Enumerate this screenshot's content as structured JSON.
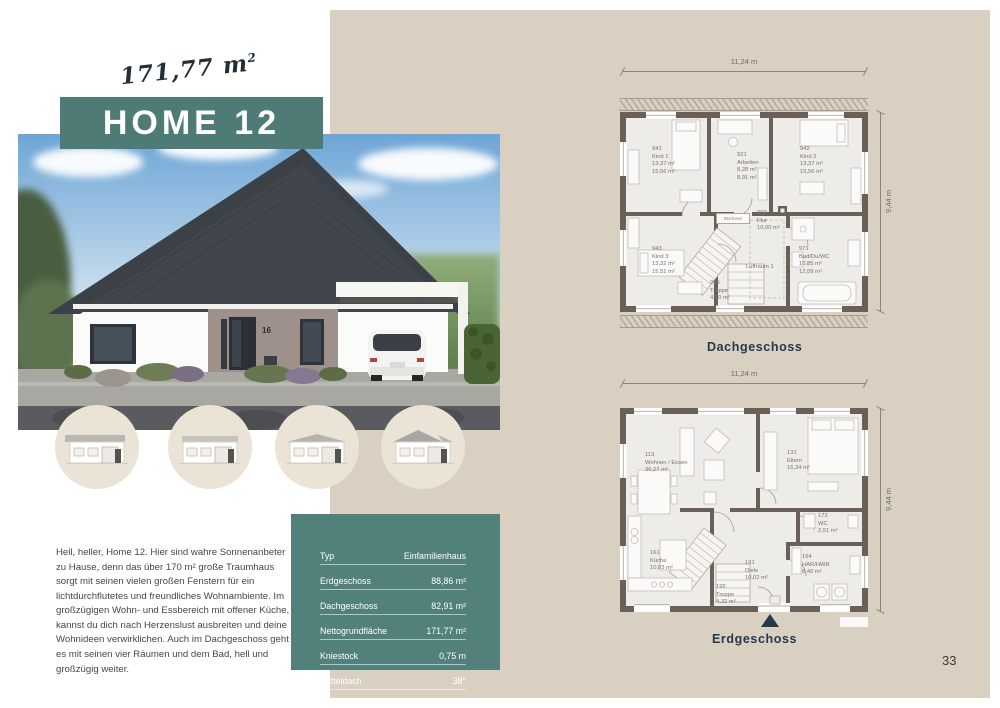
{
  "colors": {
    "accent_teal": "#4e7b76",
    "navy": "#25394c",
    "beige": "#d9d0c2"
  },
  "header": {
    "area_value": "171,77 m",
    "area_sup": "2",
    "title": "HOME 12"
  },
  "photo": {
    "house_number": "16"
  },
  "intro": "Hell, heller, Home 12. Hier sind wahre Sonnenanbeter zu Hause, denn das über 170 m² große Traumhaus sorgt mit seinen vielen großen Fenstern für ein lichtdurchflutetes und freundliches Wohnambiente. Im großzügigen Wohn- und Essbereich mit offener Küche, kannst du dich nach Herzenslust ausbreiten und deine Wohnideen verwirklichen. Auch im Dachgeschoss geht es mit seinen vier Räumen und dem Bad, hell und großzügig weiter.",
  "specs": {
    "rows": [
      {
        "label": "Typ",
        "value": "Einfamilienhaus"
      },
      {
        "label": "Erdgeschoss",
        "value": "88,86 m²"
      },
      {
        "label": "Dachgeschoss",
        "value": "82,91 m²"
      },
      {
        "label": "Nettogrundfläche",
        "value": "171,77 m²"
      },
      {
        "label": "Kniestock",
        "value": "0,75 m"
      },
      {
        "label": "Satteldach",
        "value": "38°"
      }
    ]
  },
  "plans": {
    "dg": {
      "caption": "Dachgeschoss",
      "width_dim": "11,24 m",
      "depth_dim": "9,44 m",
      "luftraum": "Luftraum 1",
      "shelf_label": "Bücherei",
      "rooms": [
        {
          "code": "941",
          "name": "Kind 1",
          "a1": "13,37 m²",
          "a2": "15,56 m²"
        },
        {
          "code": "921",
          "name": "Arbeiten",
          "a1": "8,28 m²",
          "a2": "8,91 m²"
        },
        {
          "code": "942",
          "name": "Kind 2",
          "a1": "13,37 m²",
          "a2": "15,56 m²"
        },
        {
          "code": "943",
          "name": "Kind 3",
          "a1": "13,32 m²",
          "a2": "15,51 m²"
        },
        {
          "code": "992",
          "name": "Flur",
          "a1": "10,00 m²"
        },
        {
          "code": "971",
          "name": "Bad/Du/WC",
          "a1": "10,85 m²",
          "a2": "12,09 m²"
        },
        {
          "code": "995",
          "name": "Treppe",
          "a1": "4,30 m²"
        }
      ]
    },
    "eg": {
      "caption": "Erdgeschoss",
      "width_dim": "11,24 m",
      "depth_dim": "9,44 m",
      "rooms": [
        {
          "code": "113",
          "name": "Wohnen / Essen",
          "a1": "36,27 m²"
        },
        {
          "code": "131",
          "name": "Eltern",
          "a1": "16,34 m²"
        },
        {
          "code": "161",
          "name": "Küche",
          "a1": "10,83 m²"
        },
        {
          "code": "191",
          "name": "Diele",
          "a1": "10,02 m²"
        },
        {
          "code": "195",
          "name": "Treppe",
          "a1": "4,32 m²"
        },
        {
          "code": "164",
          "name": "HAR/HWR",
          "a1": "8,40 m²"
        },
        {
          "code": "172",
          "name": "WC",
          "a1": "2,51 m²"
        }
      ]
    }
  },
  "page_number": "33"
}
